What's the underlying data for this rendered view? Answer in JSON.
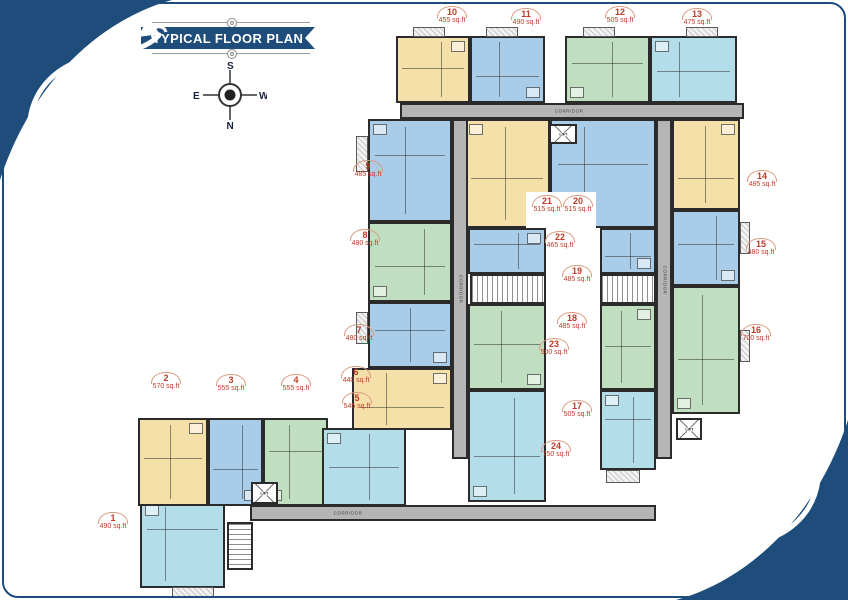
{
  "title_banner": "TYPICAL FLOOR PLAN",
  "compass": {
    "top": "S",
    "bottom": "N",
    "left": "E",
    "right": "W"
  },
  "colors": {
    "navy": "#1e4d7b",
    "label_red": "#bf3a28",
    "wall": "#2b2b2b",
    "corridor_gray": "#b5b5b5",
    "yellow": "#f5e0a9",
    "blue": "#a9cde8",
    "green": "#c0dfc0",
    "cyan": "#b2dde9"
  },
  "plan": {
    "units": [
      {
        "no": "1",
        "area": "490 sq.ft",
        "color": "cyan",
        "rect": [
          140,
          500,
          85,
          88
        ],
        "label_pos": [
          113,
          514
        ]
      },
      {
        "no": "2",
        "area": "570 sq.ft",
        "color": "yellow",
        "rect": [
          138,
          418,
          70,
          88
        ],
        "label_pos": [
          166,
          374
        ]
      },
      {
        "no": "3",
        "area": "555 sq.ft",
        "color": "blue",
        "rect": [
          208,
          418,
          55,
          88
        ],
        "label_pos": [
          231,
          376
        ]
      },
      {
        "no": "4",
        "area": "555 sq.ft",
        "color": "green",
        "rect": [
          263,
          418,
          65,
          88
        ],
        "label_pos": [
          296,
          376
        ]
      },
      {
        "no": "5",
        "area": "545 sq.ft",
        "color": "cyan",
        "rect": [
          322,
          428,
          84,
          78
        ],
        "label_pos": [
          357,
          394
        ]
      },
      {
        "no": "6",
        "area": "440 sq.ft",
        "color": "yellow",
        "rect": [
          352,
          368,
          100,
          62
        ],
        "label_pos": [
          356,
          368
        ]
      },
      {
        "no": "7",
        "area": "480 sq.ft",
        "color": "blue",
        "rect": [
          368,
          302,
          84,
          66
        ],
        "label_pos": [
          359,
          326
        ]
      },
      {
        "no": "8",
        "area": "480 sq.ft",
        "color": "green",
        "rect": [
          368,
          222,
          84,
          80
        ],
        "label_pos": [
          365,
          231
        ]
      },
      {
        "no": "9",
        "area": "485 sq.ft",
        "color": "blue",
        "rect": [
          368,
          119,
          84,
          103
        ],
        "label_pos": [
          368,
          162
        ]
      },
      {
        "no": "10",
        "area": "455 sq.ft",
        "color": "yellow",
        "rect": [
          396,
          36,
          74,
          67
        ],
        "label_pos": [
          452,
          8
        ]
      },
      {
        "no": "11",
        "area": "490 sq.ft",
        "color": "blue",
        "rect": [
          470,
          36,
          75,
          67
        ],
        "label_pos": [
          526,
          10
        ]
      },
      {
        "no": "12",
        "area": "505 sq.ft",
        "color": "green",
        "rect": [
          565,
          36,
          85,
          67
        ],
        "label_pos": [
          620,
          8
        ]
      },
      {
        "no": "13",
        "area": "475 sq.ft",
        "color": "cyan",
        "rect": [
          650,
          36,
          87,
          67
        ],
        "label_pos": [
          697,
          10
        ]
      },
      {
        "no": "14",
        "area": "485 sq.ft",
        "color": "yellow",
        "rect": [
          672,
          119,
          68,
          91
        ],
        "label_pos": [
          762,
          172
        ]
      },
      {
        "no": "15",
        "area": "480 sq.ft",
        "color": "blue",
        "rect": [
          672,
          210,
          68,
          76
        ],
        "label_pos": [
          761,
          240
        ]
      },
      {
        "no": "16",
        "area": "700 sq.ft",
        "color": "green",
        "rect": [
          672,
          286,
          68,
          128
        ],
        "label_pos": [
          756,
          326
        ]
      },
      {
        "no": "17",
        "area": "505 sq.ft",
        "color": "cyan",
        "rect": [
          600,
          390,
          56,
          80
        ],
        "label_pos": [
          577,
          402
        ]
      },
      {
        "no": "18",
        "area": "485 sq.ft",
        "color": "green",
        "rect": [
          600,
          304,
          56,
          86
        ],
        "label_pos": [
          572,
          314
        ]
      },
      {
        "no": "19",
        "area": "485 sq.ft",
        "color": "blue",
        "rect": [
          600,
          228,
          56,
          46
        ],
        "label_pos": [
          577,
          267
        ]
      },
      {
        "no": "20",
        "area": "515 sq.ft",
        "color": "blue",
        "rect": [
          550,
          119,
          106,
          109
        ],
        "label_pos": [
          578,
          197
        ]
      },
      {
        "no": "21",
        "area": "515 sq.ft",
        "color": "yellow",
        "rect": [
          464,
          119,
          86,
          109
        ],
        "label_pos": [
          547,
          197
        ]
      },
      {
        "no": "22",
        "area": "465 sq.ft",
        "color": "blue",
        "rect": [
          468,
          228,
          78,
          46
        ],
        "label_pos": [
          560,
          233
        ]
      },
      {
        "no": "23",
        "area": "500 sq.ft",
        "color": "green",
        "rect": [
          468,
          304,
          78,
          86
        ],
        "label_pos": [
          554,
          340
        ]
      },
      {
        "no": "24",
        "area": "750 sq.ft",
        "color": "cyan",
        "rect": [
          468,
          390,
          78,
          112
        ],
        "label_pos": [
          556,
          442
        ]
      }
    ],
    "corridors": [
      {
        "label": "CORRIDOR",
        "rect": [
          400,
          103,
          344,
          16
        ],
        "orientation": "h",
        "label_at": 0.42
      },
      {
        "label": "CORRIDOR",
        "rect": [
          452,
          119,
          16,
          340
        ],
        "orientation": "v",
        "label_at": 0.5
      },
      {
        "label": "CORRIDOR",
        "rect": [
          656,
          119,
          16,
          340
        ],
        "orientation": "v",
        "label_at": 0.45
      },
      {
        "label": "CORRIDOR",
        "rect": [
          250,
          505,
          406,
          16
        ],
        "orientation": "h",
        "label_at": 0.18
      }
    ],
    "lifts": [
      {
        "label": "LIFT",
        "rect": [
          549,
          124,
          28,
          20
        ]
      },
      {
        "label": "LIFT",
        "rect": [
          676,
          418,
          26,
          22
        ]
      },
      {
        "label": "LIFT",
        "rect": [
          251,
          482,
          27,
          22
        ]
      }
    ],
    "stairs": [
      {
        "rect": [
          470,
          274,
          76,
          30
        ],
        "dir": "h"
      },
      {
        "rect": [
          600,
          274,
          56,
          30
        ],
        "dir": "h"
      },
      {
        "rect": [
          227,
          522,
          26,
          48
        ],
        "dir": "v"
      }
    ],
    "balconies": [
      [
        413,
        27,
        32,
        10
      ],
      [
        486,
        27,
        32,
        10
      ],
      [
        583,
        27,
        32,
        10
      ],
      [
        686,
        27,
        32,
        10
      ],
      [
        356,
        136,
        12,
        36
      ],
      [
        356,
        312,
        12,
        32
      ],
      [
        740,
        222,
        10,
        32
      ],
      [
        740,
        330,
        10,
        32
      ],
      [
        172,
        587,
        42,
        10
      ],
      [
        606,
        470,
        34,
        13
      ]
    ],
    "voids": [
      [
        526,
        192,
        70,
        36
      ]
    ]
  }
}
